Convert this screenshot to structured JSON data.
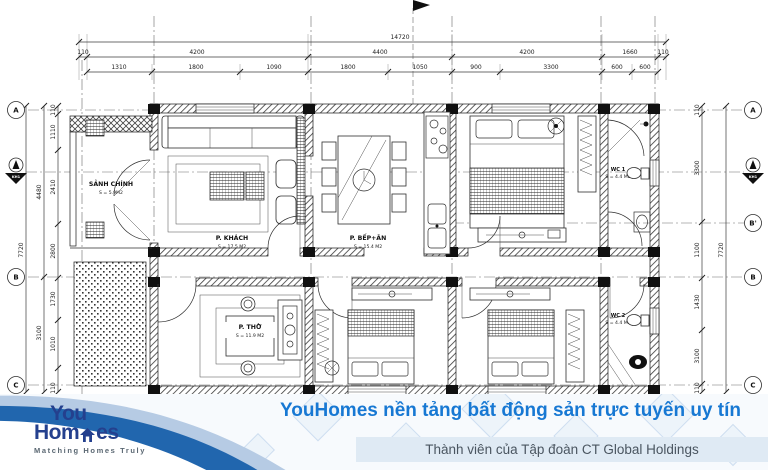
{
  "plan": {
    "rooms": {
      "sanh": {
        "name": "SẢNH CHÍNH",
        "area": "S = 5.9M2"
      },
      "khach": {
        "name": "P. KHÁCH",
        "area": "S = 17.5 M2"
      },
      "bep": {
        "name": "P. BẾP+ĂN",
        "area": "S = 15.4 M2"
      },
      "tho": {
        "name": "P. THỜ",
        "area": "S = 11.9 M2"
      },
      "wc1": {
        "name": "WC 1",
        "area": "S = 4.4 M2"
      },
      "wc2": {
        "name": "WC 2",
        "area": "S = 4.4 M2"
      }
    },
    "grid_bubbles": {
      "left": [
        "A",
        "B",
        "C"
      ],
      "right": [
        "A",
        "B'",
        "B",
        "C"
      ],
      "section": "KH1"
    },
    "dims": {
      "top_total": "14720",
      "top_bays": [
        "110",
        "4200",
        "4400",
        "4200",
        "1660",
        "110"
      ],
      "top_sub": [
        "1310",
        "1800",
        "1090",
        "1800",
        "1050",
        "900",
        "3300",
        "600",
        "600"
      ],
      "left_total": "7720",
      "left_mid": [
        "4480",
        "3100"
      ],
      "left_inner": [
        "110",
        "1110",
        "2410",
        "2800",
        "1730",
        "1010",
        "110"
      ],
      "right_total": "7720",
      "right_inner": [
        "110",
        "3300",
        "1100",
        "1430",
        "3100",
        "110"
      ]
    }
  },
  "banner": {
    "logo_line1": "You",
    "logo_line2a": "Hom",
    "logo_line2b": "es",
    "tagline": "Matching Homes Truly",
    "slogan": "YouHomes nền tảng bất động sản trực tuyến uy tín",
    "subtitle": "Thành viên của Tập đoàn CT Global Holdings",
    "colors": {
      "slogan_blue": "#1778d3",
      "logo_navy": "#24408e",
      "swoosh_dark": "#2166ae",
      "swoosh_light": "#b6cbe4",
      "subtitle_bg": "#dfeaf4"
    }
  }
}
